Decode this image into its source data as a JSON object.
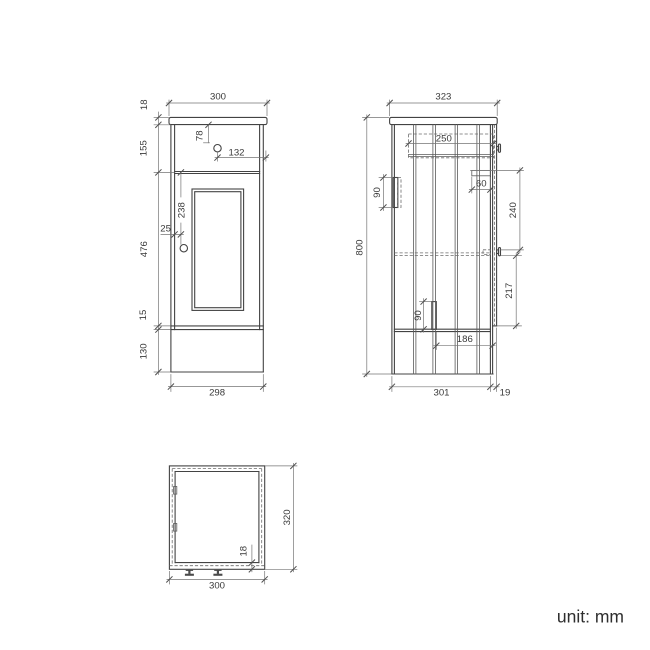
{
  "unit": {
    "label": "unit: mm"
  },
  "front_view": {
    "overall_width": "300",
    "countertop_thickness": "18",
    "drawer_front_height": "155",
    "drawer_knob_from_top": "78",
    "drawer_knob_from_right": "132",
    "door_knob_from_top": "238",
    "door_knob_from_edge": "25",
    "door_height": "476",
    "bottom_rail_height": "15",
    "plinth_height": "130",
    "base_width": "298"
  },
  "side_view": {
    "countertop_depth": "323",
    "drawer_depth": "250",
    "wall_bracket_height": "90",
    "hinge_depth": "60",
    "hinge_to_knob_spacing": "240",
    "overall_height": "800",
    "knob_to_door_bottom": "217",
    "support_bracket_height": "90",
    "support_to_front": "186",
    "body_depth": "301",
    "door_projection": "19"
  },
  "bottom_view": {
    "overall_depth": "320",
    "panel_thickness": "18",
    "overall_width": "300"
  },
  "colors": {
    "object_line": "#434343",
    "dimension_line": "#757575",
    "text": "#3a3a3a"
  }
}
